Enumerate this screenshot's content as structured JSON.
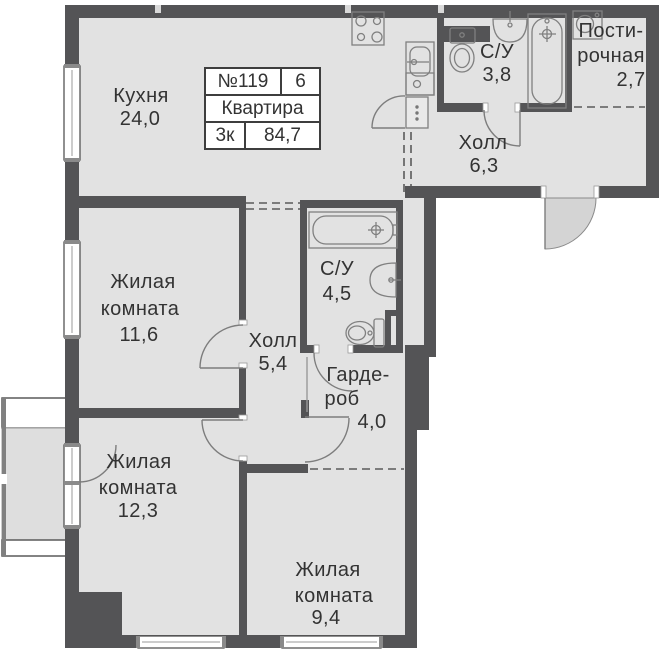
{
  "apartment_info": {
    "number": "№119",
    "floor": "6",
    "type_label": "Квартира",
    "rooms_label": "3к",
    "total_area": "84,7"
  },
  "rooms": {
    "kitchen": {
      "name": "Кухня",
      "area": "24,0"
    },
    "bathroom_small": {
      "name": "С/У",
      "area": "3,8"
    },
    "laundry": {
      "name_line1": "Пости-",
      "name_line2": "рочная",
      "area": "2,7"
    },
    "hall_entry": {
      "name": "Холл",
      "area": "6,3"
    },
    "living_1": {
      "name_line1": "Жилая",
      "name_line2": "комната",
      "area": "11,6"
    },
    "hall_inner": {
      "name": "Холл",
      "area": "5,4"
    },
    "bathroom_large": {
      "name": "С/У",
      "area": "4,5"
    },
    "wardrobe": {
      "name_line1": "Гарде-",
      "name_line2": "роб",
      "area": "4,0"
    },
    "living_2": {
      "name_line1": "Жилая",
      "name_line2": "комната",
      "area": "12,3"
    },
    "living_3": {
      "name_line1": "Жилая",
      "name_line2": "комната",
      "area": "9,4"
    }
  },
  "colors": {
    "wall": "#545456",
    "floor": "#e2e2e2",
    "door_swing_shade": "#d4d4d4",
    "loggia_floor": "#dedede",
    "text": "#333333",
    "fixture_outline": "#808080"
  }
}
